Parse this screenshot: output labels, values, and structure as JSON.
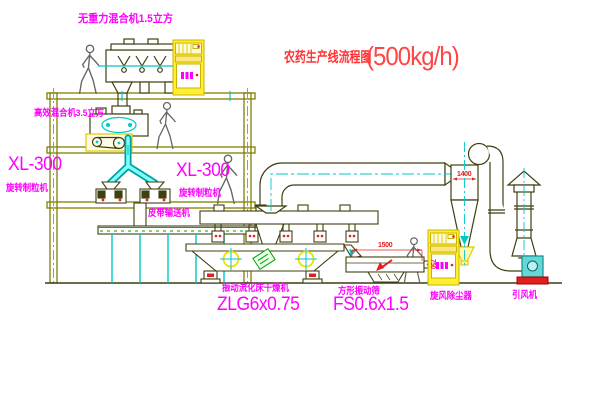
{
  "title": {
    "text": "农药生产线流程图",
    "capacity": "(500kg/h)"
  },
  "equipment_labels": {
    "gravity_free_mixer": "无重力混合机1.5立方",
    "high_efficiency_mixer": "高效混合机3.5立方",
    "granulator_left_model": "XL-300",
    "granulator_left_name": "旋转制粒机",
    "granulator_right_model": "XL-300",
    "granulator_right_name": "旋转制粒机",
    "belt_conveyor": "皮带输送机",
    "fluid_bed_dryer_name": "振动流化床干燥机",
    "fluid_bed_dryer_model": "ZLG6x0.75",
    "square_sieve_name": "方形振动筛",
    "square_sieve_model": "FS0.6x1.5",
    "cyclone": "旋风除尘器",
    "fan": "引风机"
  },
  "dimensions": {
    "sieve_length": "1500",
    "sieve_height": "750",
    "cyclone_width": "1400"
  },
  "colors": {
    "structure": "#7f7f00",
    "machine_line": "#3f3f10",
    "centerline": "#00c8c8",
    "label": "#ff00ff",
    "title": "#ff3333",
    "cabinet": "#ffee33",
    "stamp_green": "#00a000",
    "alert_red": "#e02020"
  }
}
